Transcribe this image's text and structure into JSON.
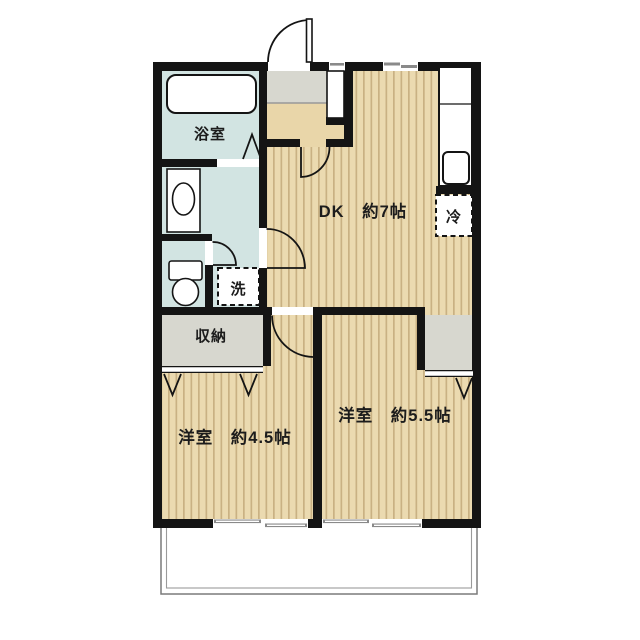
{
  "labels": {
    "bathroom": "浴室",
    "laundry": "洗",
    "storage": "収納",
    "fridge": "冷",
    "dining_kitchen": "DK　約7帖",
    "bedroom_left": "洋室　約4.5帖",
    "bedroom_right": "洋室　約5.5帖"
  },
  "colors": {
    "wall": "#141414",
    "wood_floor_base": "#ebdab0",
    "wood_floor_stripe": "#c9b183",
    "wet_area": "#d2e4e2",
    "entry_storage_gray": "#d7d7cf",
    "hall_beige": "#e9d6a9",
    "balcony_line": "#7a7a7a",
    "background": "#ffffff"
  }
}
